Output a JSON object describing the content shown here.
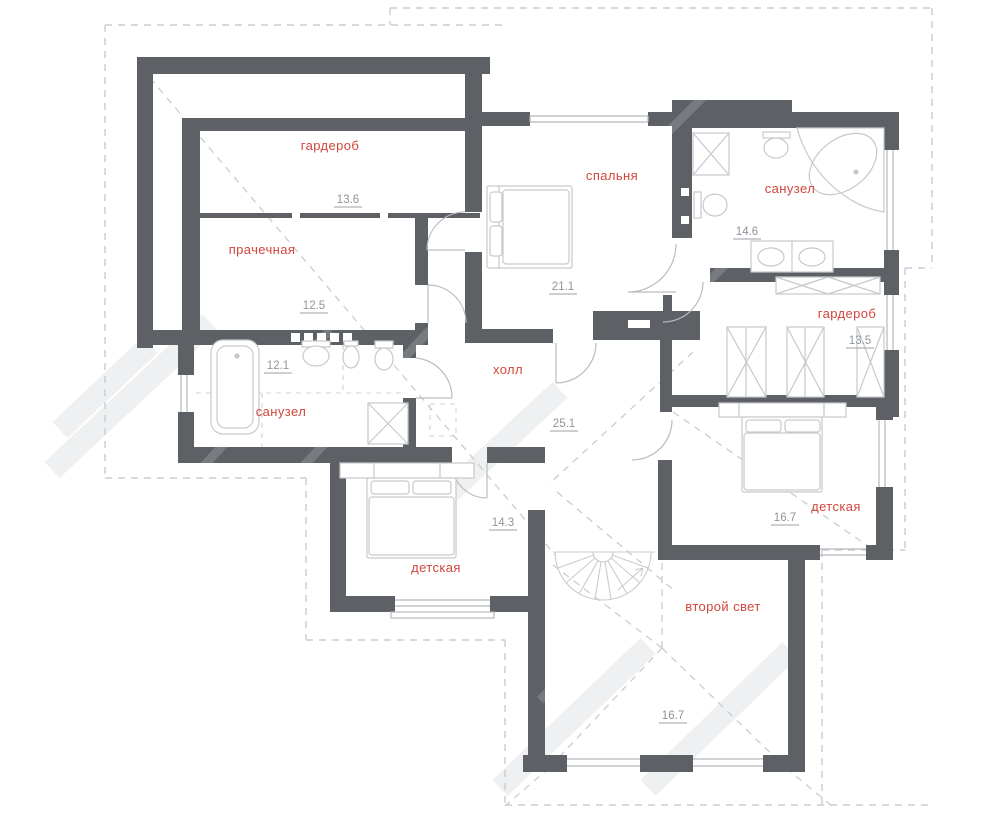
{
  "plan": {
    "rooms": [
      {
        "id": "wardrobe-left",
        "label": "гардероб",
        "area": "13.6"
      },
      {
        "id": "laundry",
        "label": "прачечная",
        "area": "12.5"
      },
      {
        "id": "bathroom-left",
        "label": "санузел",
        "area": "12.1"
      },
      {
        "id": "bedroom",
        "label": "спальня",
        "area": "21.1"
      },
      {
        "id": "bathroom-right",
        "label": "санузел",
        "area": "14.6"
      },
      {
        "id": "wardrobe-right",
        "label": "гардероб",
        "area": "13.5"
      },
      {
        "id": "hall",
        "label": "холл",
        "area": "25.1"
      },
      {
        "id": "nursery-left",
        "label": "детская",
        "area": "14.3"
      },
      {
        "id": "nursery-right",
        "label": "детская",
        "area": "16.7"
      },
      {
        "id": "second-light",
        "label": "второй свет",
        "area": "16.7"
      }
    ],
    "colors": {
      "wall": "#5d6166",
      "room_label": "#d2463b",
      "area_value": "#8f959a",
      "fixture_line": "#c6c9cc",
      "roof_dash": "#c9cdd0"
    }
  }
}
